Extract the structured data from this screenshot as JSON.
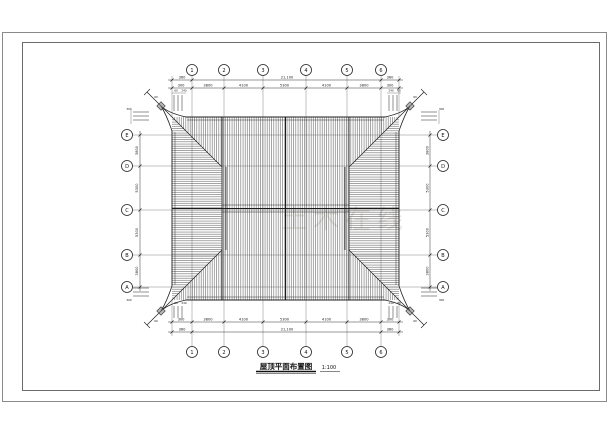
{
  "drawing": {
    "title": "屋顶平面布置图",
    "scale": "1:100",
    "watermark": "土木在线",
    "grid": {
      "top_labels": [
        "1",
        "2",
        "3",
        "4",
        "5",
        "6"
      ],
      "bottom_labels": [
        "1",
        "2",
        "3",
        "4",
        "5",
        "6"
      ],
      "left_labels": [
        "E",
        "D",
        "C",
        "B",
        "A"
      ],
      "right_labels": [
        "E",
        "D",
        "C",
        "B",
        "A"
      ]
    },
    "dims": {
      "top_overall": "21,100",
      "bottom_overall": "21,100",
      "end_overhang": "360",
      "stub": "300",
      "top_bays": [
        "3800",
        "4100",
        "5300",
        "4100",
        "3800"
      ],
      "bottom_bays": [
        "3800",
        "4100",
        "5300",
        "4100",
        "3800"
      ],
      "left_bays": [
        "3800",
        "5300",
        "5300",
        "3800"
      ],
      "right_bays": [
        "3800",
        "5300",
        "5300",
        "3800"
      ],
      "micro_a": "60",
      "micro_b": "240",
      "micro_c": "300"
    }
  }
}
